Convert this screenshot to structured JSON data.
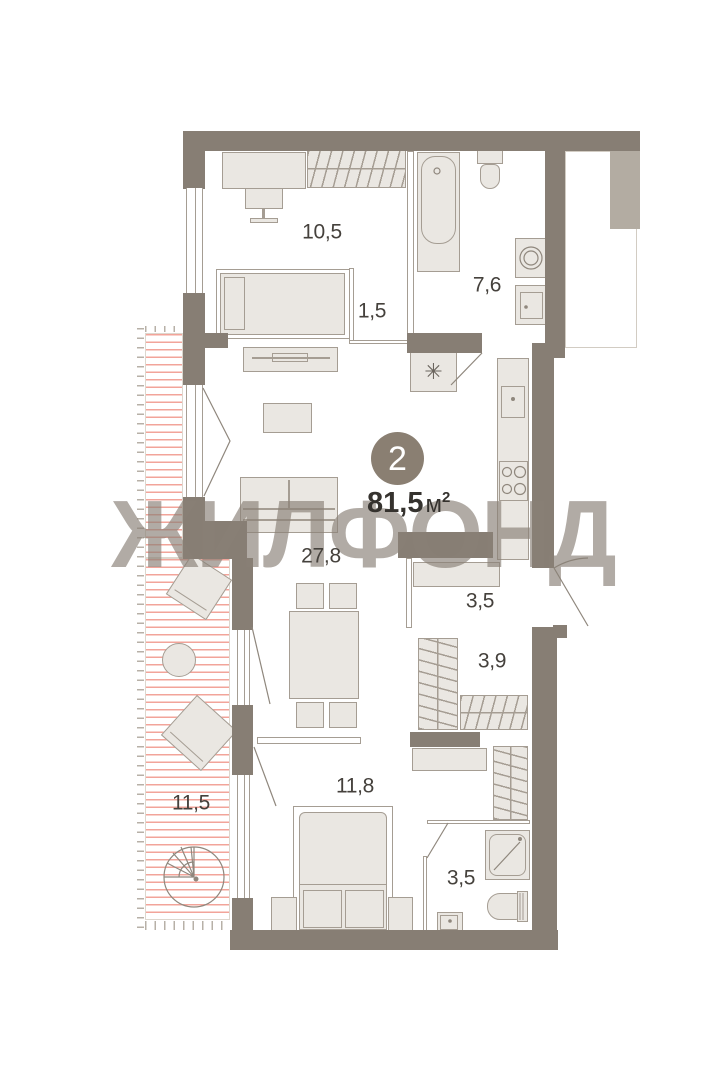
{
  "watermark": {
    "text": "ЖИЛФОНД"
  },
  "badge": {
    "room_count": "2"
  },
  "area": {
    "value": "81,5",
    "unit": "м",
    "superscript": "2"
  },
  "rooms": [
    {
      "name": "bedroom-top",
      "area": "10,5"
    },
    {
      "name": "storage",
      "area": "1,5"
    },
    {
      "name": "bathroom-top",
      "area": "7,6"
    },
    {
      "name": "living-room",
      "area": "27,8"
    },
    {
      "name": "hallway",
      "area": "3,5"
    },
    {
      "name": "wardrobe",
      "area": "3,9"
    },
    {
      "name": "bedroom-bottom",
      "area": "11,8"
    },
    {
      "name": "terrace",
      "area": "11,5"
    },
    {
      "name": "bathroom-bottom",
      "area": "3,5"
    }
  ],
  "icons": {
    "water_heater": "✳"
  },
  "colors": {
    "wall": "#877e74",
    "wall_light": "#b3aca2",
    "furniture": "#eae7e2",
    "furniture_border": "#a59d93",
    "hatch": "#f2a49a",
    "watermark": "#8a8177",
    "badge": "#8a7f72",
    "text": "#45413c",
    "background": "#ffffff"
  }
}
